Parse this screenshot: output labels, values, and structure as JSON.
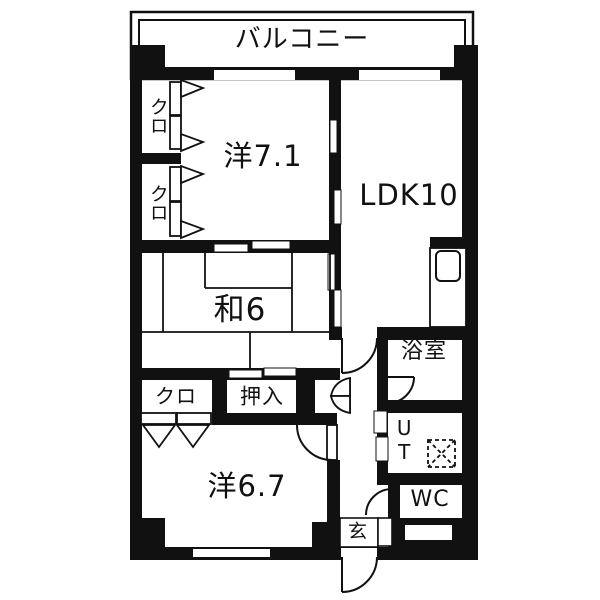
{
  "plan_title": "apartment-floor-plan",
  "colors": {
    "wall": "#111111",
    "background": "#ffffff",
    "line": "#111111"
  },
  "labels": {
    "balcony": "バルコニー",
    "western_room_1": "洋7.1",
    "ldk": "LDK10",
    "closet_1": "クロ",
    "closet_2": "クロ",
    "japanese_room": "和6",
    "bathroom": "浴室",
    "utility": "UT",
    "closet_3": "クロ",
    "oshiire": "押入",
    "western_room_2": "洋6.7",
    "wc": "WC",
    "entrance": "玄"
  }
}
